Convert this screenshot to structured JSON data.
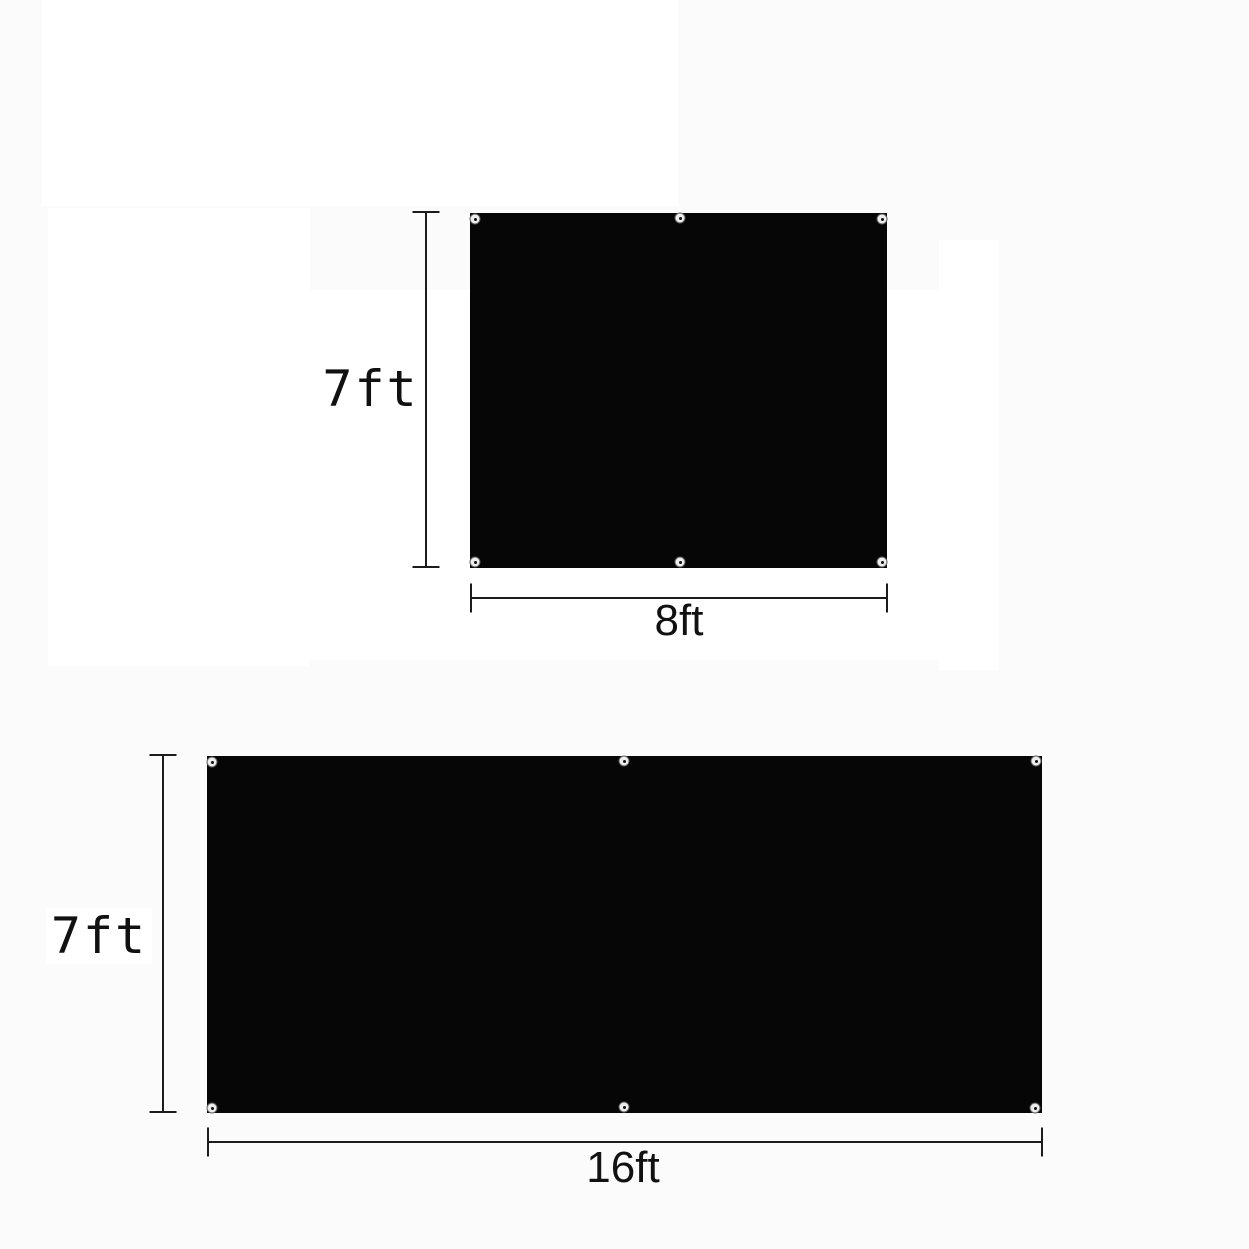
{
  "page": {
    "background": "#fbfbfb",
    "description_labels_visible": [
      "7ft",
      "8ft",
      "7ft",
      "16ft"
    ]
  },
  "figures": [
    {
      "name": "tarp-panel-8ft-by-7ft",
      "height_label": "7ft",
      "width_label": "8ft",
      "grommet_count": 6,
      "fill": "#060606"
    },
    {
      "name": "tarp-panel-16ft-by-7ft",
      "height_label": "7ft",
      "width_label": "16ft",
      "grommet_count": 6,
      "fill": "#060606"
    }
  ],
  "colors": {
    "dimension_line": "#1c1c1c",
    "label_text": "#111111",
    "label_box": "#ffffff",
    "grommet_ring": "#ededed",
    "grommet_ring_border": "#5e5e5e",
    "grommet_hole": "#101010"
  }
}
